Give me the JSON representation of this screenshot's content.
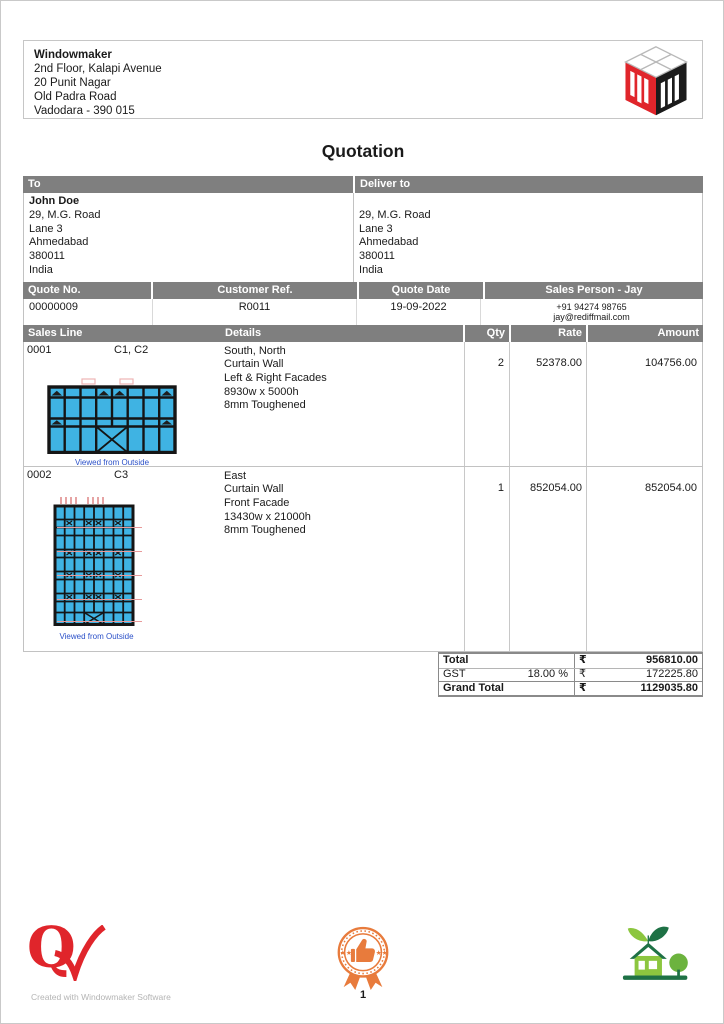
{
  "title": "Quotation",
  "company": {
    "name": "Windowmaker",
    "address_lines": [
      "2nd Floor, Kalapi Avenue",
      "20 Punit Nagar",
      "Old Padra Road",
      "Vadodara - 390 015"
    ]
  },
  "to": {
    "header": "To",
    "name": "John Doe",
    "lines": [
      "29, M.G. Road",
      "Lane 3",
      "Ahmedabad",
      "380011",
      "India"
    ]
  },
  "deliver_to": {
    "header": "Deliver to",
    "lines": [
      "29, M.G. Road",
      "Lane 3",
      "Ahmedabad",
      "380011",
      "India"
    ]
  },
  "meta": {
    "quote_no_label": "Quote No.",
    "quote_no": "00000009",
    "customer_ref_label": "Customer Ref.",
    "customer_ref": "R0011",
    "quote_date_label": "Quote Date",
    "quote_date": "19-09-2022",
    "sales_person_label": "Sales Person - Jay",
    "sales_person_phone": "+91 94274 98765",
    "sales_person_email": "jay@rediffmail.com"
  },
  "items": {
    "headers": {
      "sales_line": "Sales Line",
      "details": "Details",
      "qty": "Qty",
      "rate": "Rate",
      "amount": "Amount"
    },
    "rows": [
      {
        "line_no": "0001",
        "positions": "C1, C2",
        "details": [
          "South, North",
          "Curtain Wall",
          "Left & Right Facades",
          "8930w x 5000h",
          "8mm Toughened"
        ],
        "qty": "2",
        "rate": "52378.00",
        "amount": "104756.00",
        "caption": "Viewed from Outside"
      },
      {
        "line_no": "0002",
        "positions": "C3",
        "details": [
          "East",
          "Curtain Wall",
          "Front Facade",
          "13430w x 21000h",
          "8mm Toughened"
        ],
        "qty": "1",
        "rate": "852054.00",
        "amount": "852054.00",
        "caption": "Viewed from Outside"
      }
    ]
  },
  "totals": {
    "rows": [
      {
        "label": "Total",
        "pct": "",
        "currency": "₹",
        "amount": "956810.00"
      },
      {
        "label": "GST",
        "pct": "18.00 %",
        "currency": "₹",
        "amount": "172225.80"
      },
      {
        "label": "Grand Total",
        "pct": "",
        "currency": "₹",
        "amount": "1129035.80"
      }
    ]
  },
  "footer": {
    "created_with": "Created with Windowmaker Software",
    "page_number": "1"
  },
  "icons": {
    "logo": "windowmaker-cube-logo",
    "quality": "quality-check-icon",
    "badge": "thumbs-up-rosette-icon",
    "eco": "eco-house-icon"
  },
  "colors": {
    "header_gray": "#7f7f7f",
    "panel_cyan": "#3fb3e3",
    "brand_red": "#e0252b",
    "badge_orange": "#e87b3c",
    "eco_green_light": "#8cc63f",
    "eco_green_dark": "#1e7145",
    "caption_blue": "#2b50c8"
  }
}
